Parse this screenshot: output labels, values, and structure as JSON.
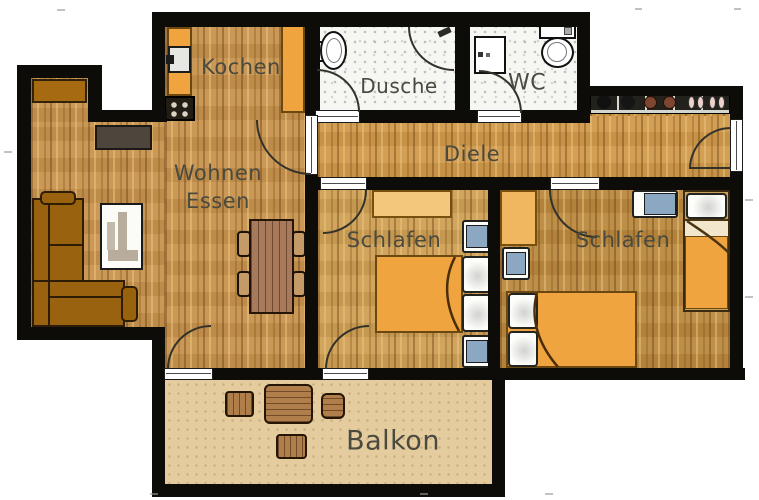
{
  "rooms": {
    "kochen": {
      "label": "Kochen"
    },
    "dusche": {
      "label": "Dusche"
    },
    "wc": {
      "label": "WC"
    },
    "diele": {
      "label": "Diele"
    },
    "wohnen_essen": {
      "line1": "Wohnen",
      "line2": "Essen"
    },
    "schlafen_links": {
      "label": "Schlafen"
    },
    "schlafen_rechts": {
      "label": "Schlafen"
    },
    "balkon": {
      "label": "Balkon"
    }
  },
  "colors": {
    "wall": "#0e0c08",
    "wood_floor": "#c8944e",
    "tile_floor": "#f6f6f3",
    "balcony_floor": "#e4cc9f",
    "furniture_orange": "#f0a440",
    "sofa_brown": "#99620f",
    "label_text": "#4a4a3f"
  }
}
